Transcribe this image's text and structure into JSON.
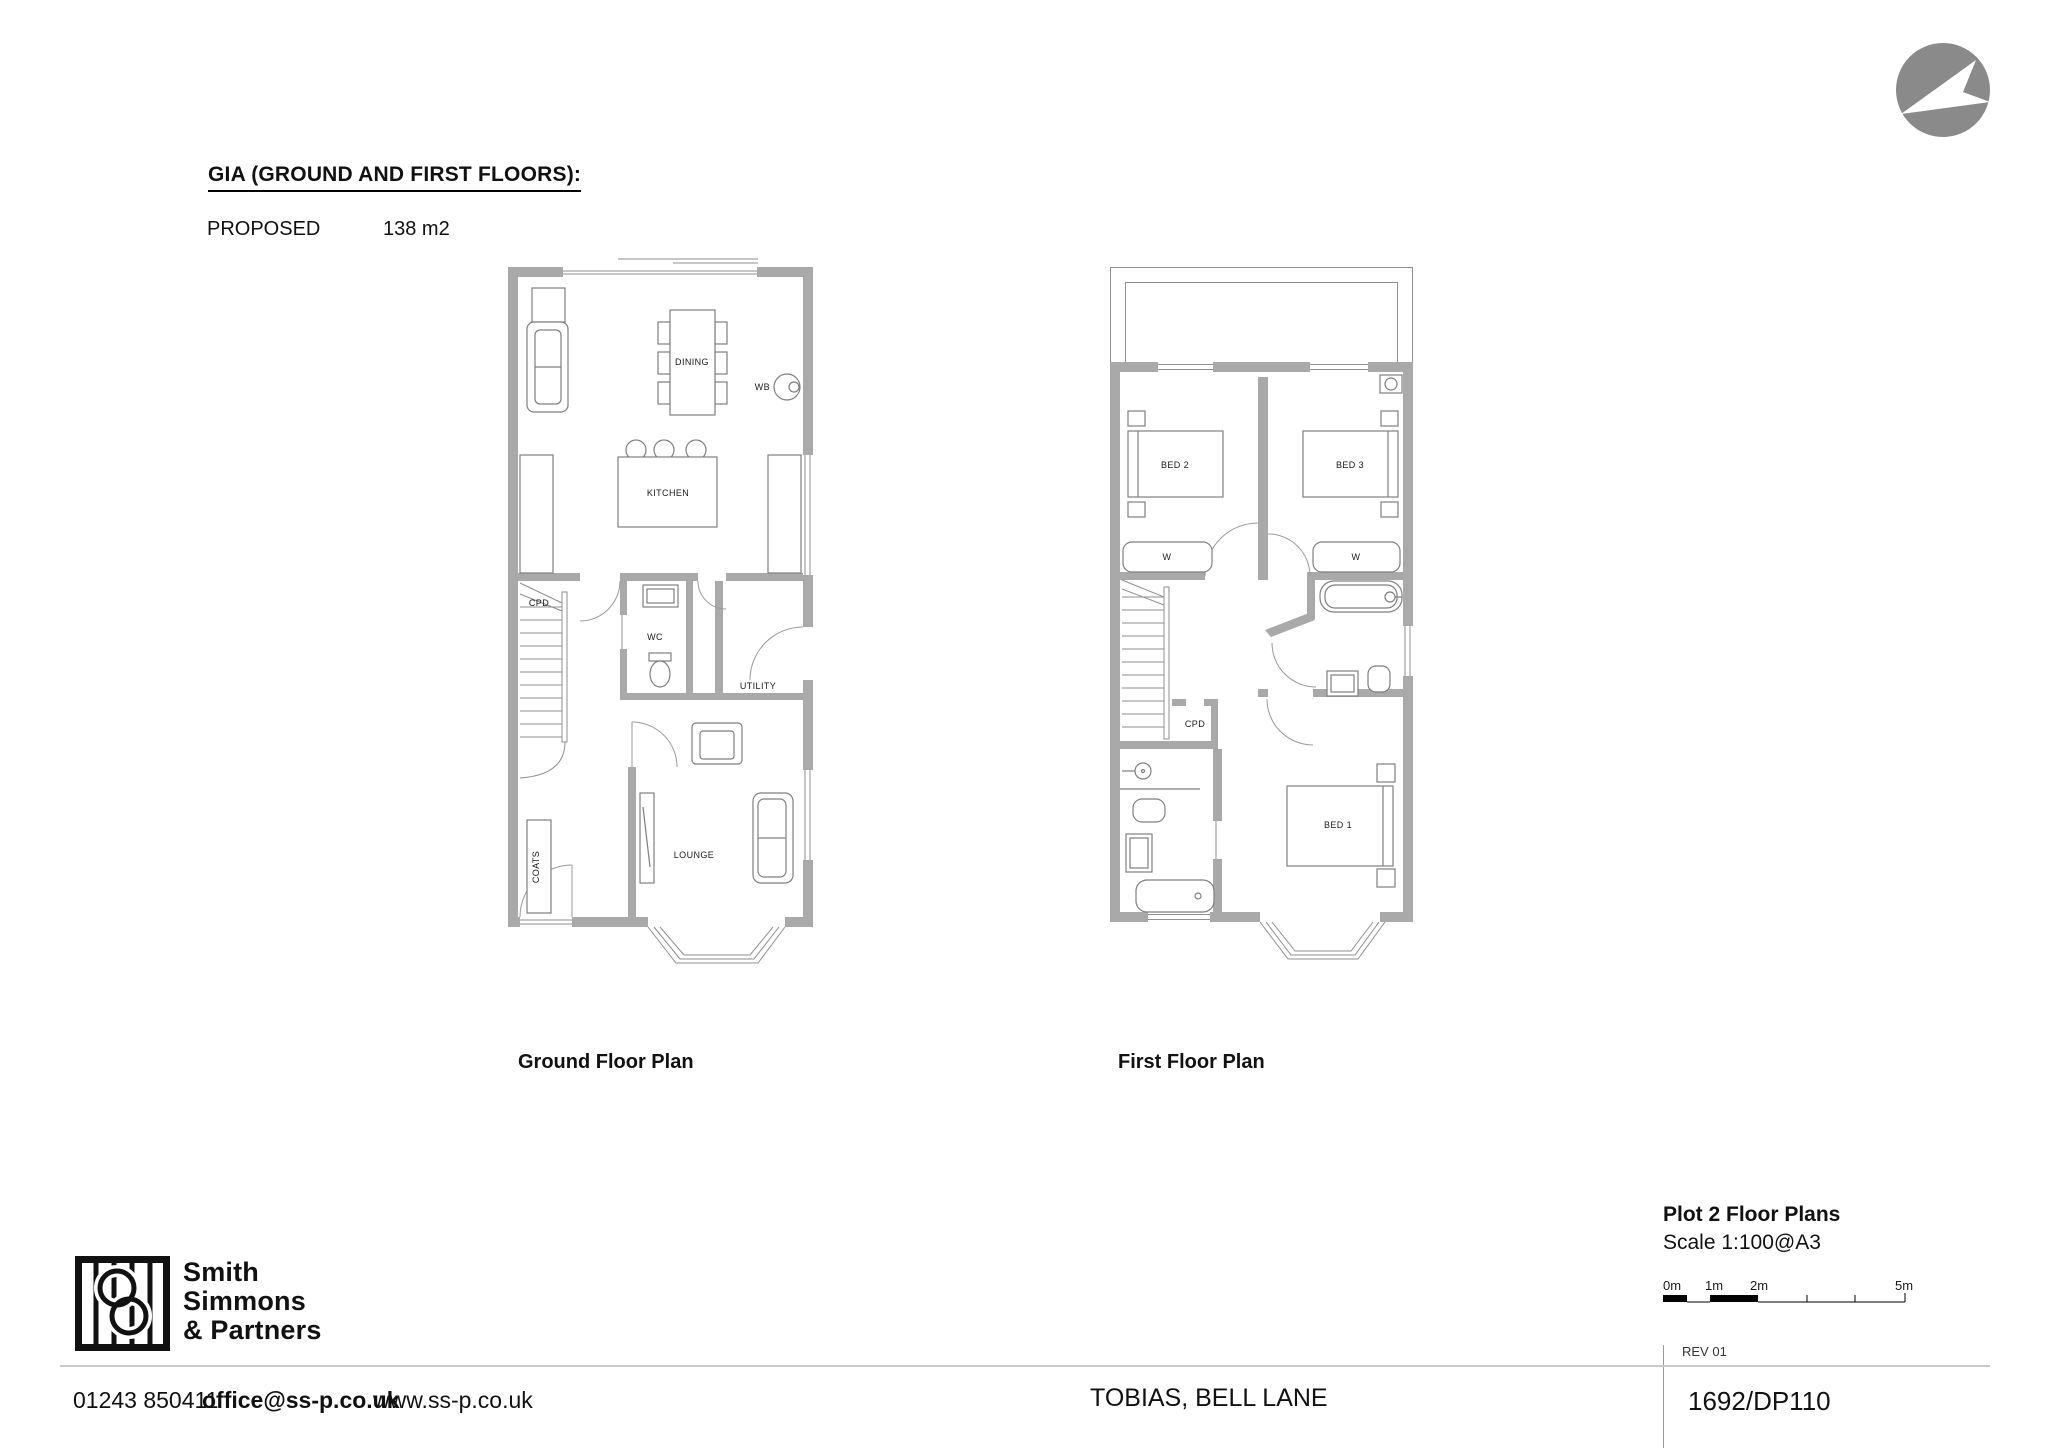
{
  "header": {
    "title": "GIA (GROUND AND FIRST FLOORS):",
    "proposed_label": "PROPOSED",
    "proposed_value": "138 m2"
  },
  "plans": {
    "ground": {
      "title": "Ground Floor Plan",
      "rooms": {
        "dining": "DINING",
        "kitchen": "KITCHEN",
        "wb": "WB",
        "cpd": "CPD",
        "wc": "WC",
        "utility": "UTILITY",
        "coats": "COATS",
        "lounge": "LOUNGE"
      }
    },
    "first": {
      "title": "First Floor Plan",
      "rooms": {
        "bed1": "BED 1",
        "bed2": "BED 2",
        "bed3": "BED 3",
        "wardrobe_left": "W",
        "wardrobe_right": "W",
        "cpd": "CPD"
      }
    }
  },
  "footer": {
    "company": {
      "line1": "Smith",
      "line2": "Simmons",
      "line3": "& Partners"
    },
    "phone": "01243 850411",
    "email": "office@ss-p.co.uk",
    "website": "www.ss-p.co.uk",
    "project": "TOBIAS, BELL LANE",
    "title_block": {
      "drawing_title": "Plot 2 Floor Plans",
      "scale": "Scale 1:100@A3",
      "rev": "REV 01",
      "drawing_number": "1692/DP110",
      "scale_bar": {
        "m0": "0m",
        "m1": "1m",
        "m2": "2m",
        "m5": "5m"
      }
    }
  },
  "colors": {
    "wall": "#a9a9a9",
    "line": "#7f7f7f",
    "arc": "#9a9a9a",
    "north": "#8a8a8a"
  }
}
